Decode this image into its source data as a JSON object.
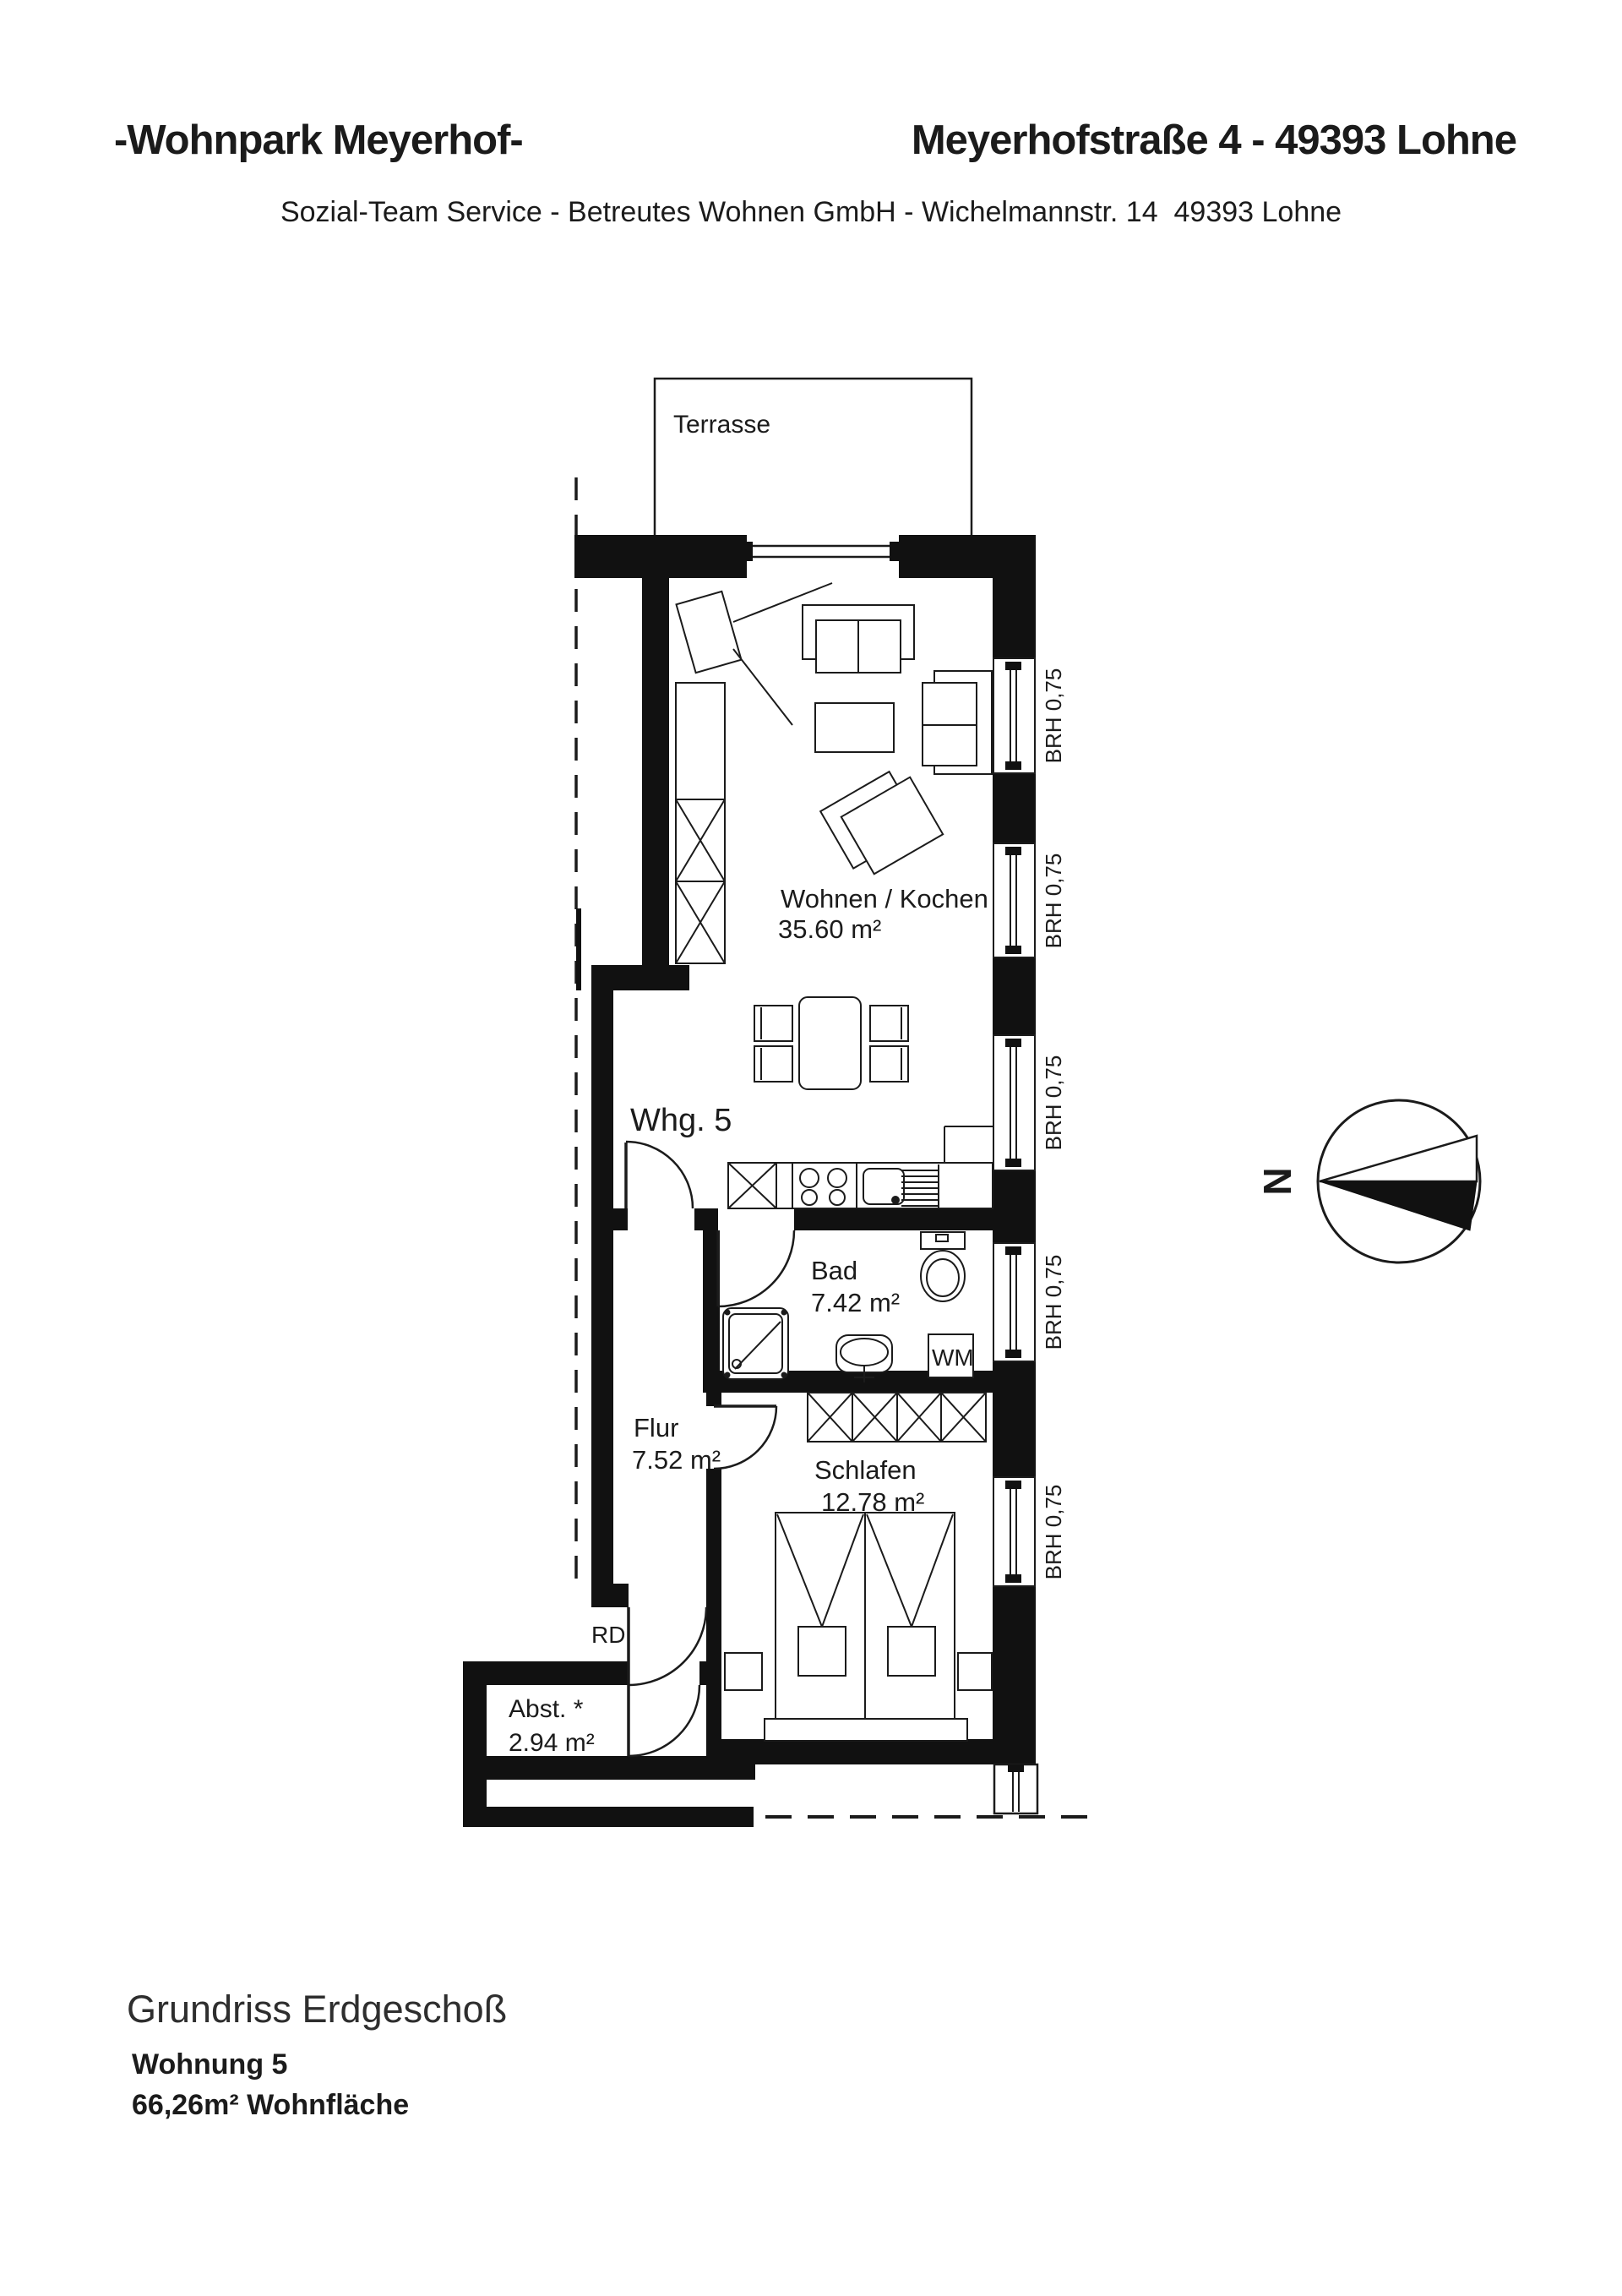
{
  "colors": {
    "ink": "#1b1b1b",
    "wall": "#111111",
    "background": "#ffffff"
  },
  "header": {
    "title_left": "-Wohnpark Meyerhof-",
    "title_right": "Meyerhofstraße 4 - 49393 Lohne",
    "subtitle": "Sozial-Team Service - Betreutes Wohnen GmbH - Wichelmannstr. 14  49393 Lohne"
  },
  "plan": {
    "terrace_label": "Terrasse",
    "apartment_label": "Whg. 5",
    "rooms": [
      {
        "name": "Wohnen / Kochen",
        "area": "35.60 m²"
      },
      {
        "name": "Bad",
        "area": "7.42 m²"
      },
      {
        "name": "Flur",
        "area": "7.52 m²"
      },
      {
        "name": "Schlafen",
        "area": "12.78 m²"
      },
      {
        "name": "Abst. *",
        "area": "2.94 m²"
      }
    ],
    "rd_label": "RD",
    "wm_label": "WM",
    "windows": [
      {
        "label": "BRH 0,75"
      },
      {
        "label": "BRH 0,75"
      },
      {
        "label": "BRH 0,75"
      },
      {
        "label": "BRH 0,75"
      },
      {
        "label": "BRH 0,75"
      }
    ],
    "compass_label": "N"
  },
  "footer": {
    "title": "Grundriss Erdgeschoß",
    "unit": "Wohnung 5",
    "area": "66,26m² Wohnfläche"
  }
}
